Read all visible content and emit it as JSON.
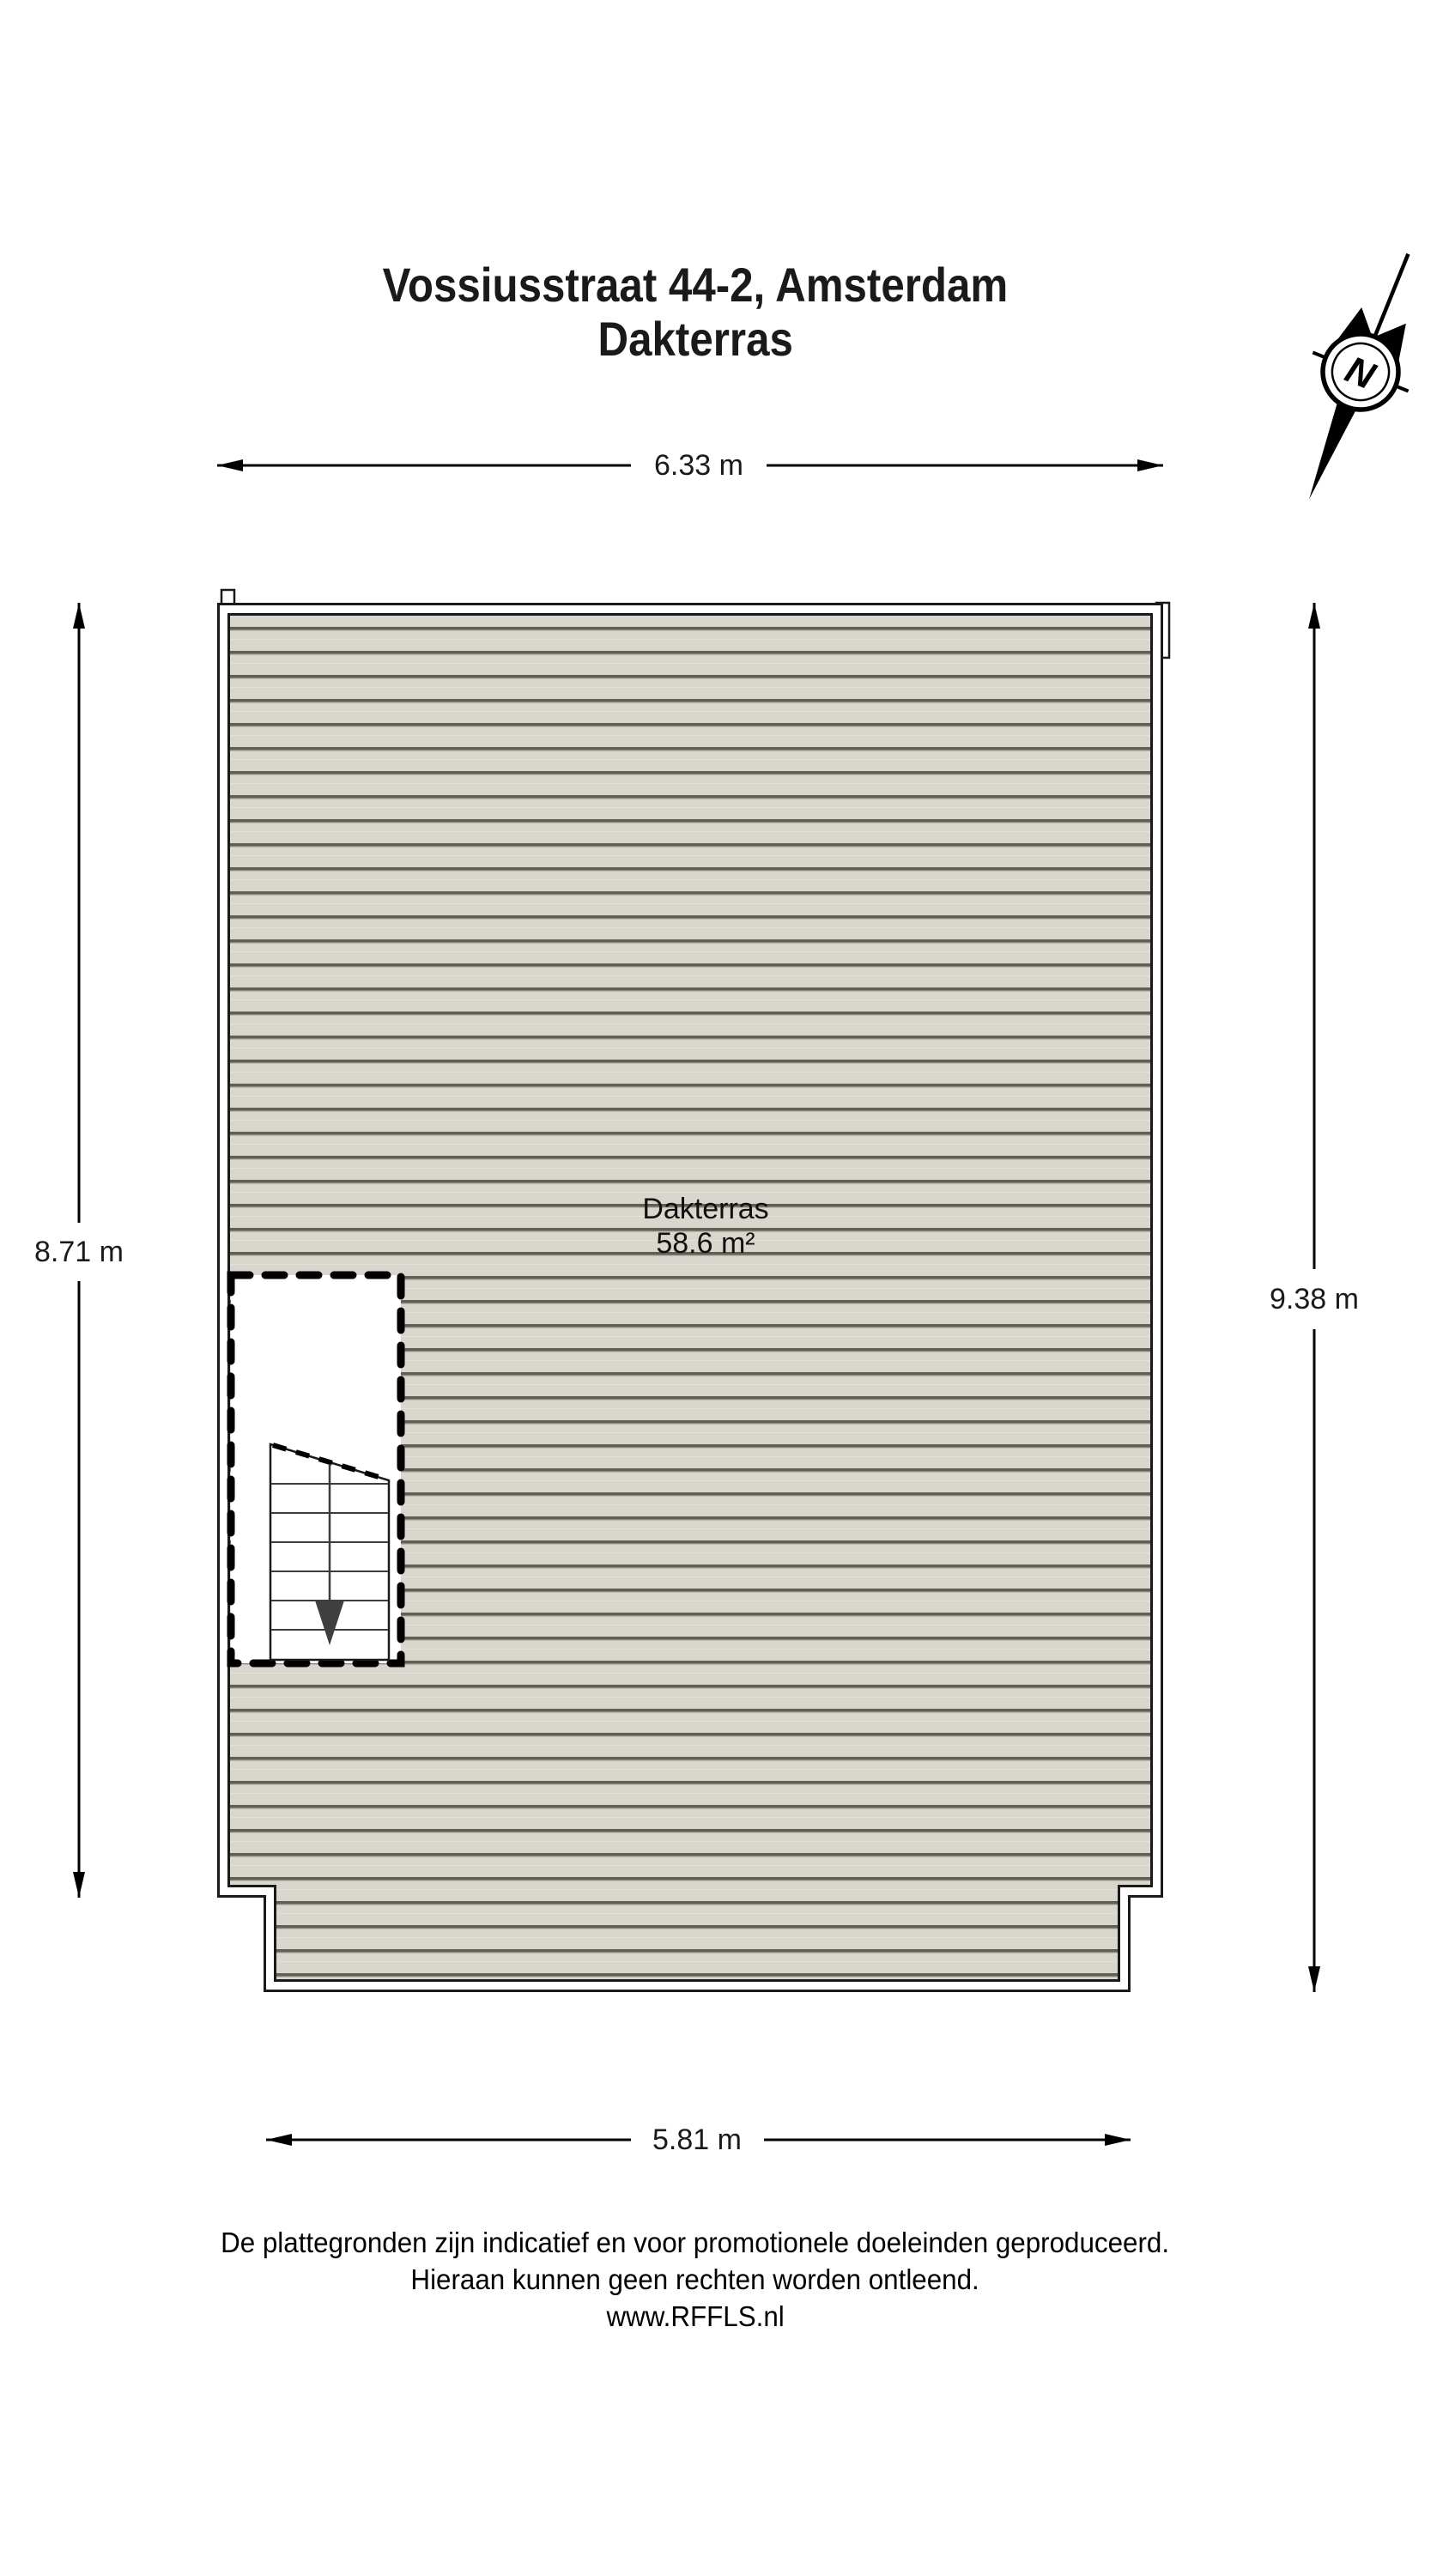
{
  "title": {
    "line1": "Vossiusstraat 44-2, Amsterdam",
    "line2": "Dakterras"
  },
  "room": {
    "name": "Dakterras",
    "area": "58.6 m²"
  },
  "dimensions": {
    "top": "6.33 m",
    "left": "8.71 m",
    "right": "9.38 m",
    "bottom": "5.81 m"
  },
  "compass": {
    "label": "N"
  },
  "footer": {
    "line1": "De plattegronden zijn indicatief en voor promotionele doeleinden geproduceerd.",
    "line2": "Hieraan kunnen geen rechten worden ontleend.",
    "line3": "www.RFFLS.nl"
  },
  "colors": {
    "deck_fill": "#d9d6ce",
    "deck_line": "#615f55",
    "wall_fill": "#ffffff",
    "outline": "#1a1a1a"
  }
}
